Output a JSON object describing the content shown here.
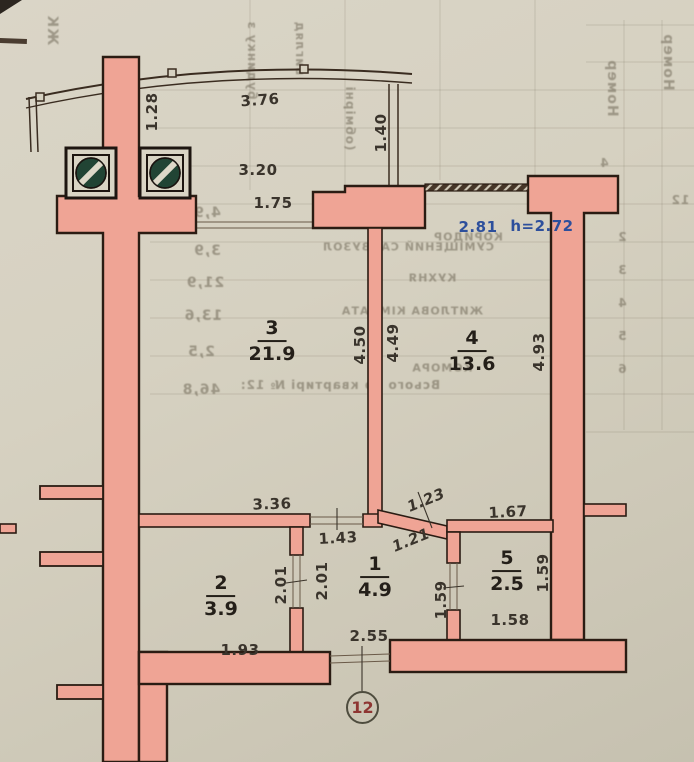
{
  "plan": {
    "apartment_circle": "12",
    "height_note": {
      "width": "2.81",
      "height": "h=2.72"
    },
    "rooms": {
      "r1": {
        "num": "1",
        "area": "4.9"
      },
      "r2": {
        "num": "2",
        "area": "3.9"
      },
      "r3": {
        "num": "3",
        "area": "21.9"
      },
      "r4": {
        "num": "4",
        "area": "13.6"
      },
      "r5": {
        "num": "5",
        "area": "2.5"
      }
    },
    "dims": {
      "balcony_left": "1.28",
      "balcony_top": "3.76",
      "balcony_right": "1.40",
      "balcony_inner": "3.20",
      "balcony_door": "1.75",
      "room3_height_left": "4.50",
      "room4_height_left": "4.49",
      "room4_height_right": "4.93",
      "room3_bottom": "3.36",
      "hall_door": "1.43",
      "angled_wall_top": "1.23",
      "angled_wall_bottom": "1.21",
      "room5_top": "1.67",
      "room2_door_left": "2.01",
      "room2_door_right": "2.01",
      "room5_door": "1.59",
      "room5_right": "1.59",
      "room5_bottom": "1.58",
      "room2_bottom": "1.93",
      "hall_bottom": "2.55"
    },
    "colors": {
      "wall_fill": "#efa495",
      "wall_outline": "#2a1c13",
      "note_blue": "#2d4f9c",
      "apartment_number_red": "#8e3532",
      "vent_green": "#214434"
    }
  },
  "bleedthrough": {
    "zk": "ЖК",
    "col1": "будинку з",
    "col2": "вигляд",
    "col3": "(обмірні",
    "nomer1": "Номер",
    "nomer2": "Номер",
    "koridor": "КОРИДОР",
    "sanvuzol": "СУМІЩЕНИЙ САНВУЗОЛ",
    "kuhnya": "КУХНЯ",
    "kimnata": "ЖИТЛОВА КІМНАТА",
    "komora": "КОМОРА",
    "vsyogo": "Всього по квартирі № 12:",
    "tbl_49": "4,9",
    "tbl_39": "3,9",
    "tbl_219": "21,9",
    "tbl_136": "13,6",
    "tbl_25": "2,5",
    "tbl_468": "46,8",
    "row2": "2",
    "row3": "3",
    "row4": "4",
    "row5": "5",
    "row6": "6",
    "c4": "4",
    "c12": "12"
  }
}
